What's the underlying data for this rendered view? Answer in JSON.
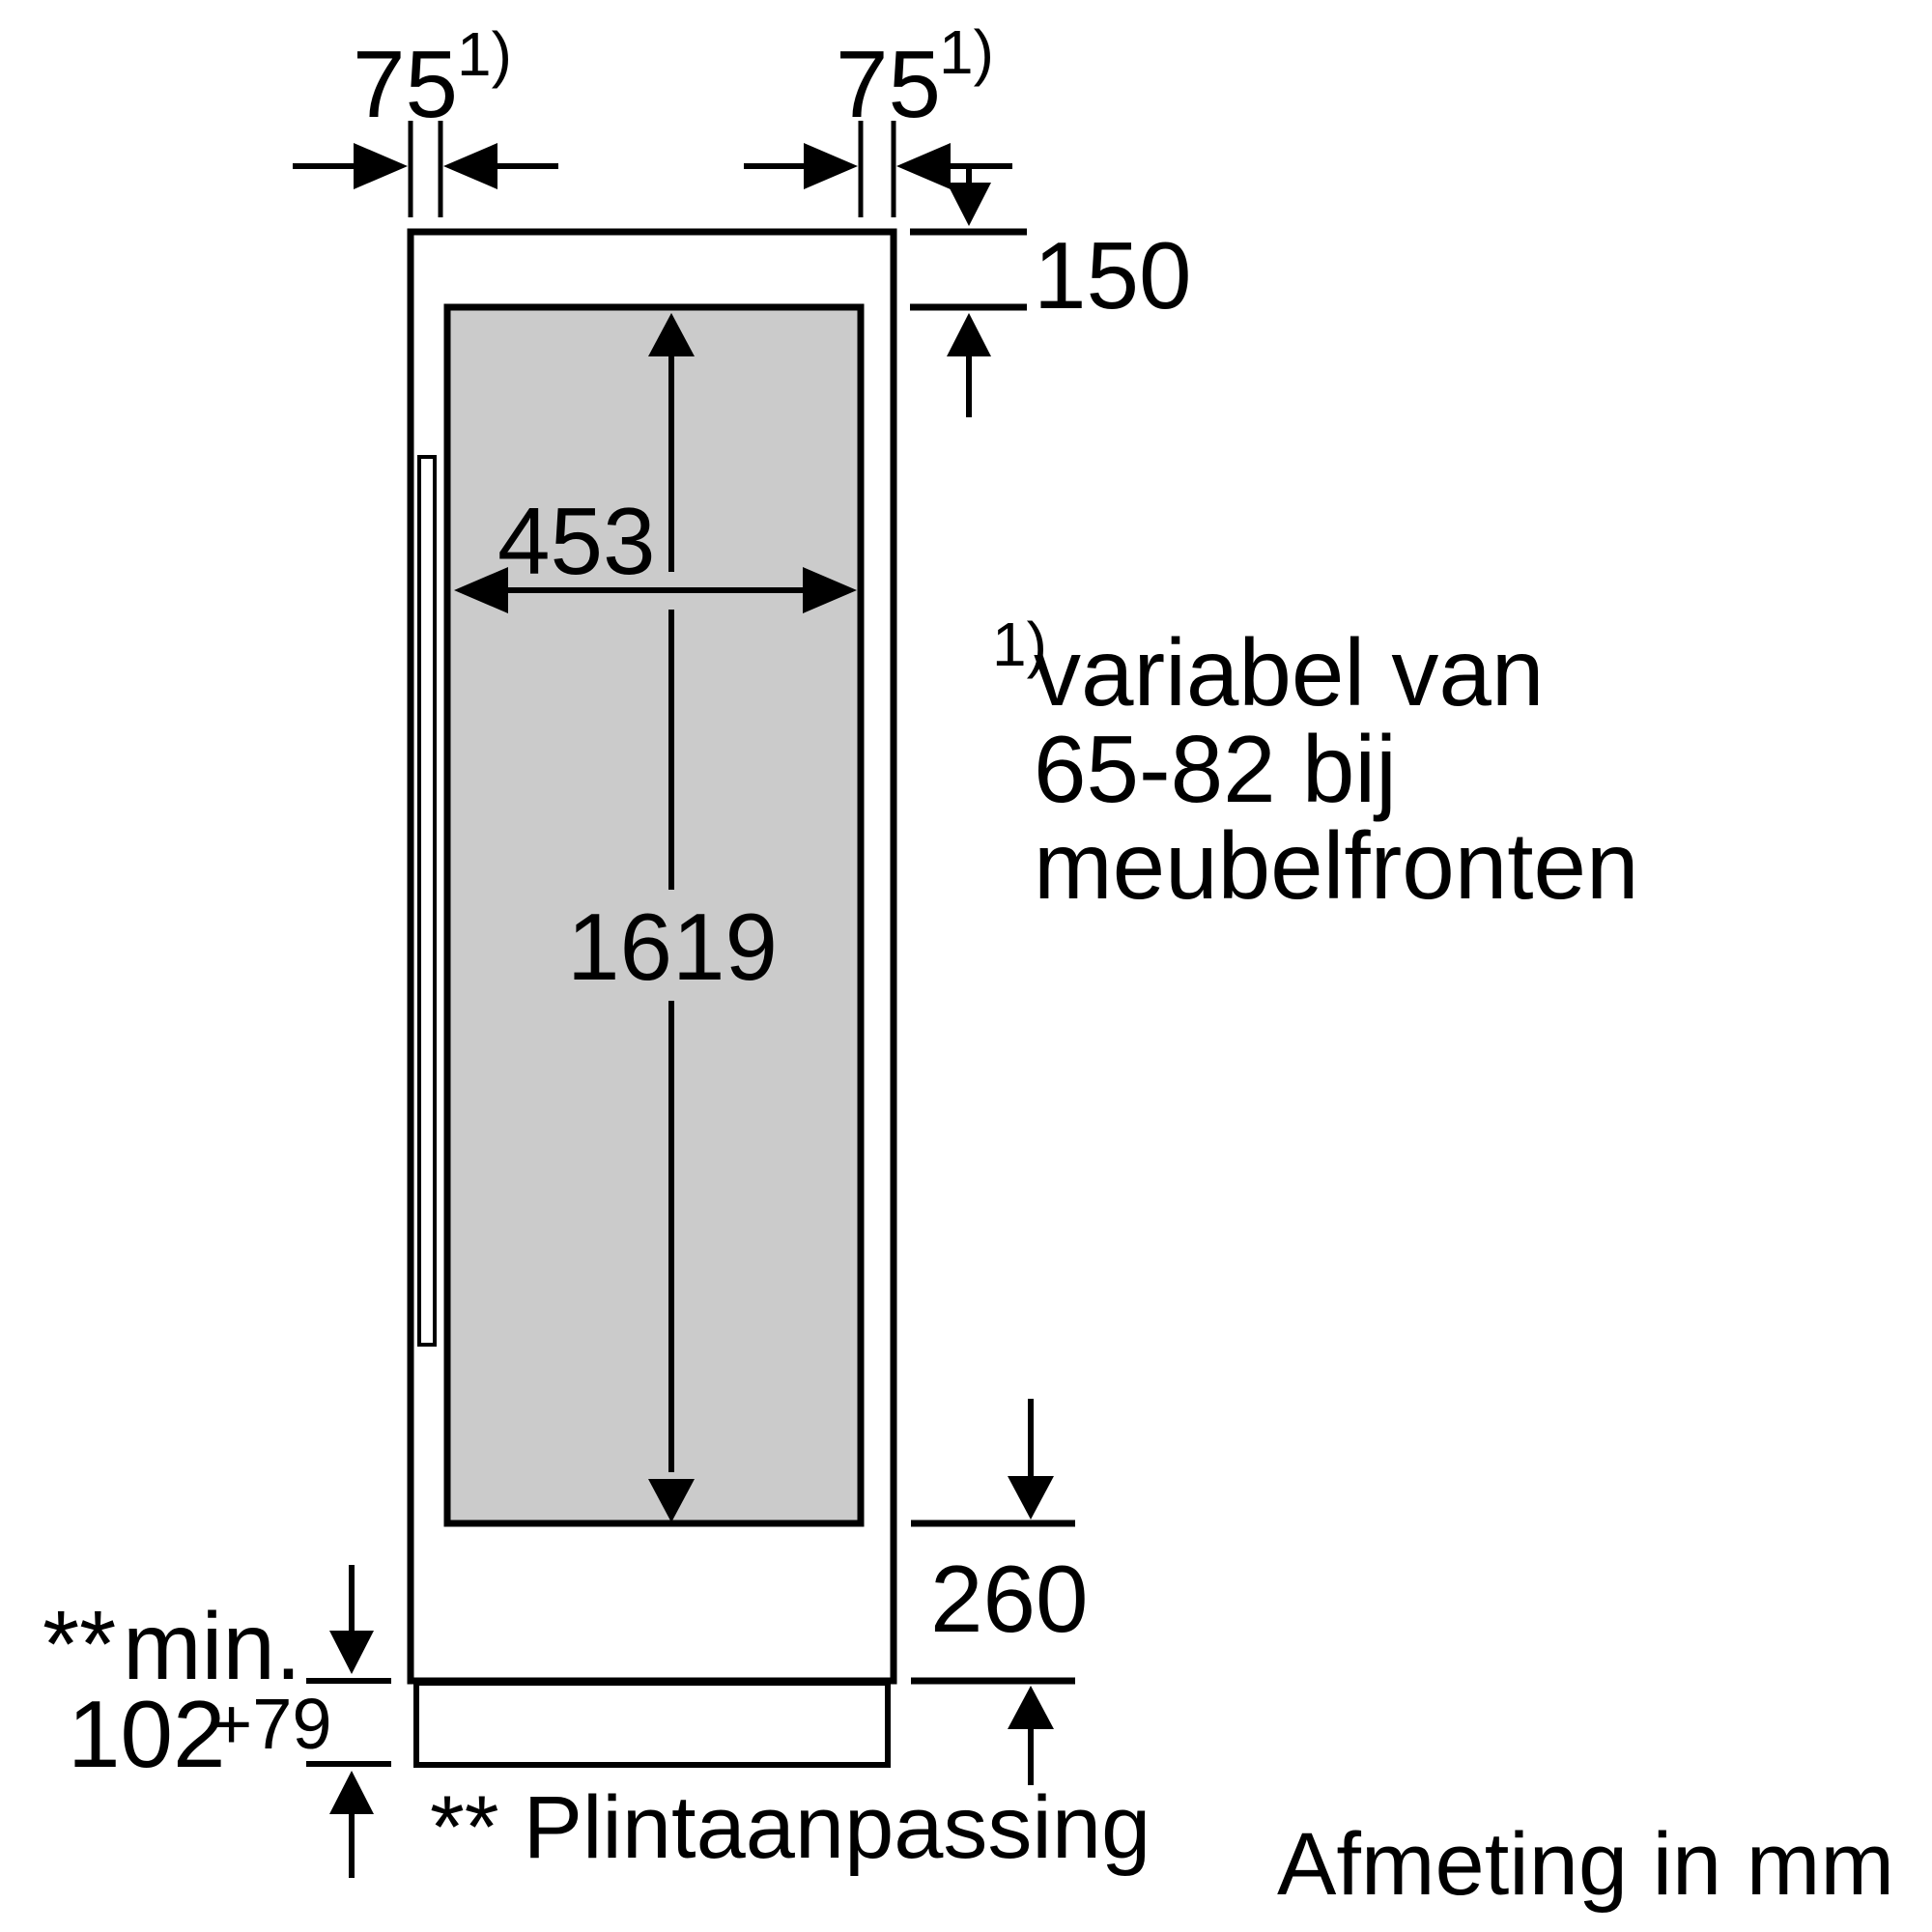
{
  "colors": {
    "line": "#000000",
    "door_fill": "#cbcbcb",
    "background": "#ffffff"
  },
  "dimensions": {
    "gap_left": {
      "value": "75",
      "ref": "1)"
    },
    "gap_right": {
      "value": "75",
      "ref": "1)"
    },
    "top_offset": {
      "value": "150"
    },
    "door_width": {
      "value": "453"
    },
    "door_height": {
      "value": "1619"
    },
    "bottom_offset": {
      "value": "260"
    },
    "plinth_height": {
      "marker": "**",
      "label": "min.",
      "value": "102",
      "tolerance": "+79"
    }
  },
  "footnote": {
    "ref": "1)",
    "line1": "variabel van",
    "line2": "65-82 bij",
    "line3": "meubelfronten"
  },
  "plinth_note": {
    "marker": "**",
    "text": "Plintaanpassing"
  },
  "units_note": "Afmeting in mm"
}
